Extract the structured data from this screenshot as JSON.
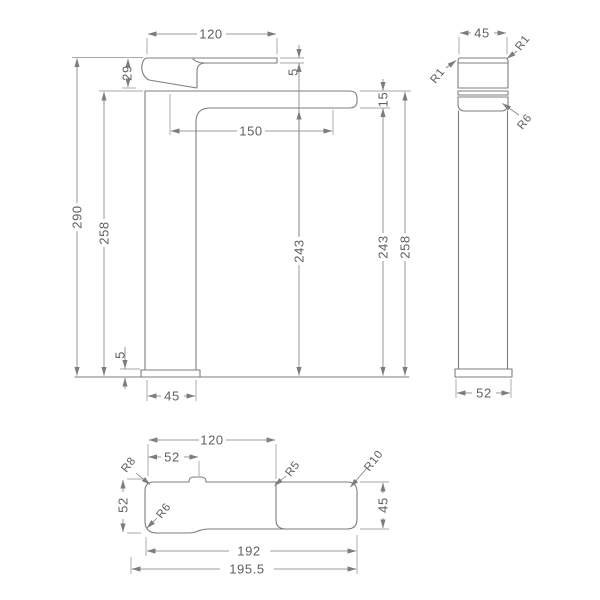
{
  "colors": {
    "line": "#7d7d7d",
    "text": "#5f5f5f",
    "background": "#ffffff"
  },
  "views": {
    "front": {
      "dims": {
        "lever_length": "120",
        "handle_height": "29",
        "lever_tip_thickness": "5",
        "spout_reach": "150",
        "overall_height": "290",
        "height_to_spout_top_left": "258",
        "height_under_spout_center": "243",
        "spout_end_depth": "15",
        "height_under_spout_right": "243",
        "height_to_spout_top_right": "258",
        "base_plate_thickness": "5",
        "body_width": "45"
      }
    },
    "side": {
      "dims": {
        "body_width": "45",
        "base_plate_width": "52"
      },
      "radii": {
        "top_left": "R1",
        "top_right": "R1",
        "spout_bottom": "R6"
      }
    },
    "plan": {
      "dims": {
        "lever_length": "120",
        "base_plate_width": "52",
        "base_plate_depth": "52",
        "spout_width": "45",
        "spout_length": "192",
        "overall_length": "195.5"
      },
      "radii": {
        "top_left": "R8",
        "bottom_left": "R6",
        "lever_end": "R5",
        "spout_end": "R10"
      }
    }
  }
}
